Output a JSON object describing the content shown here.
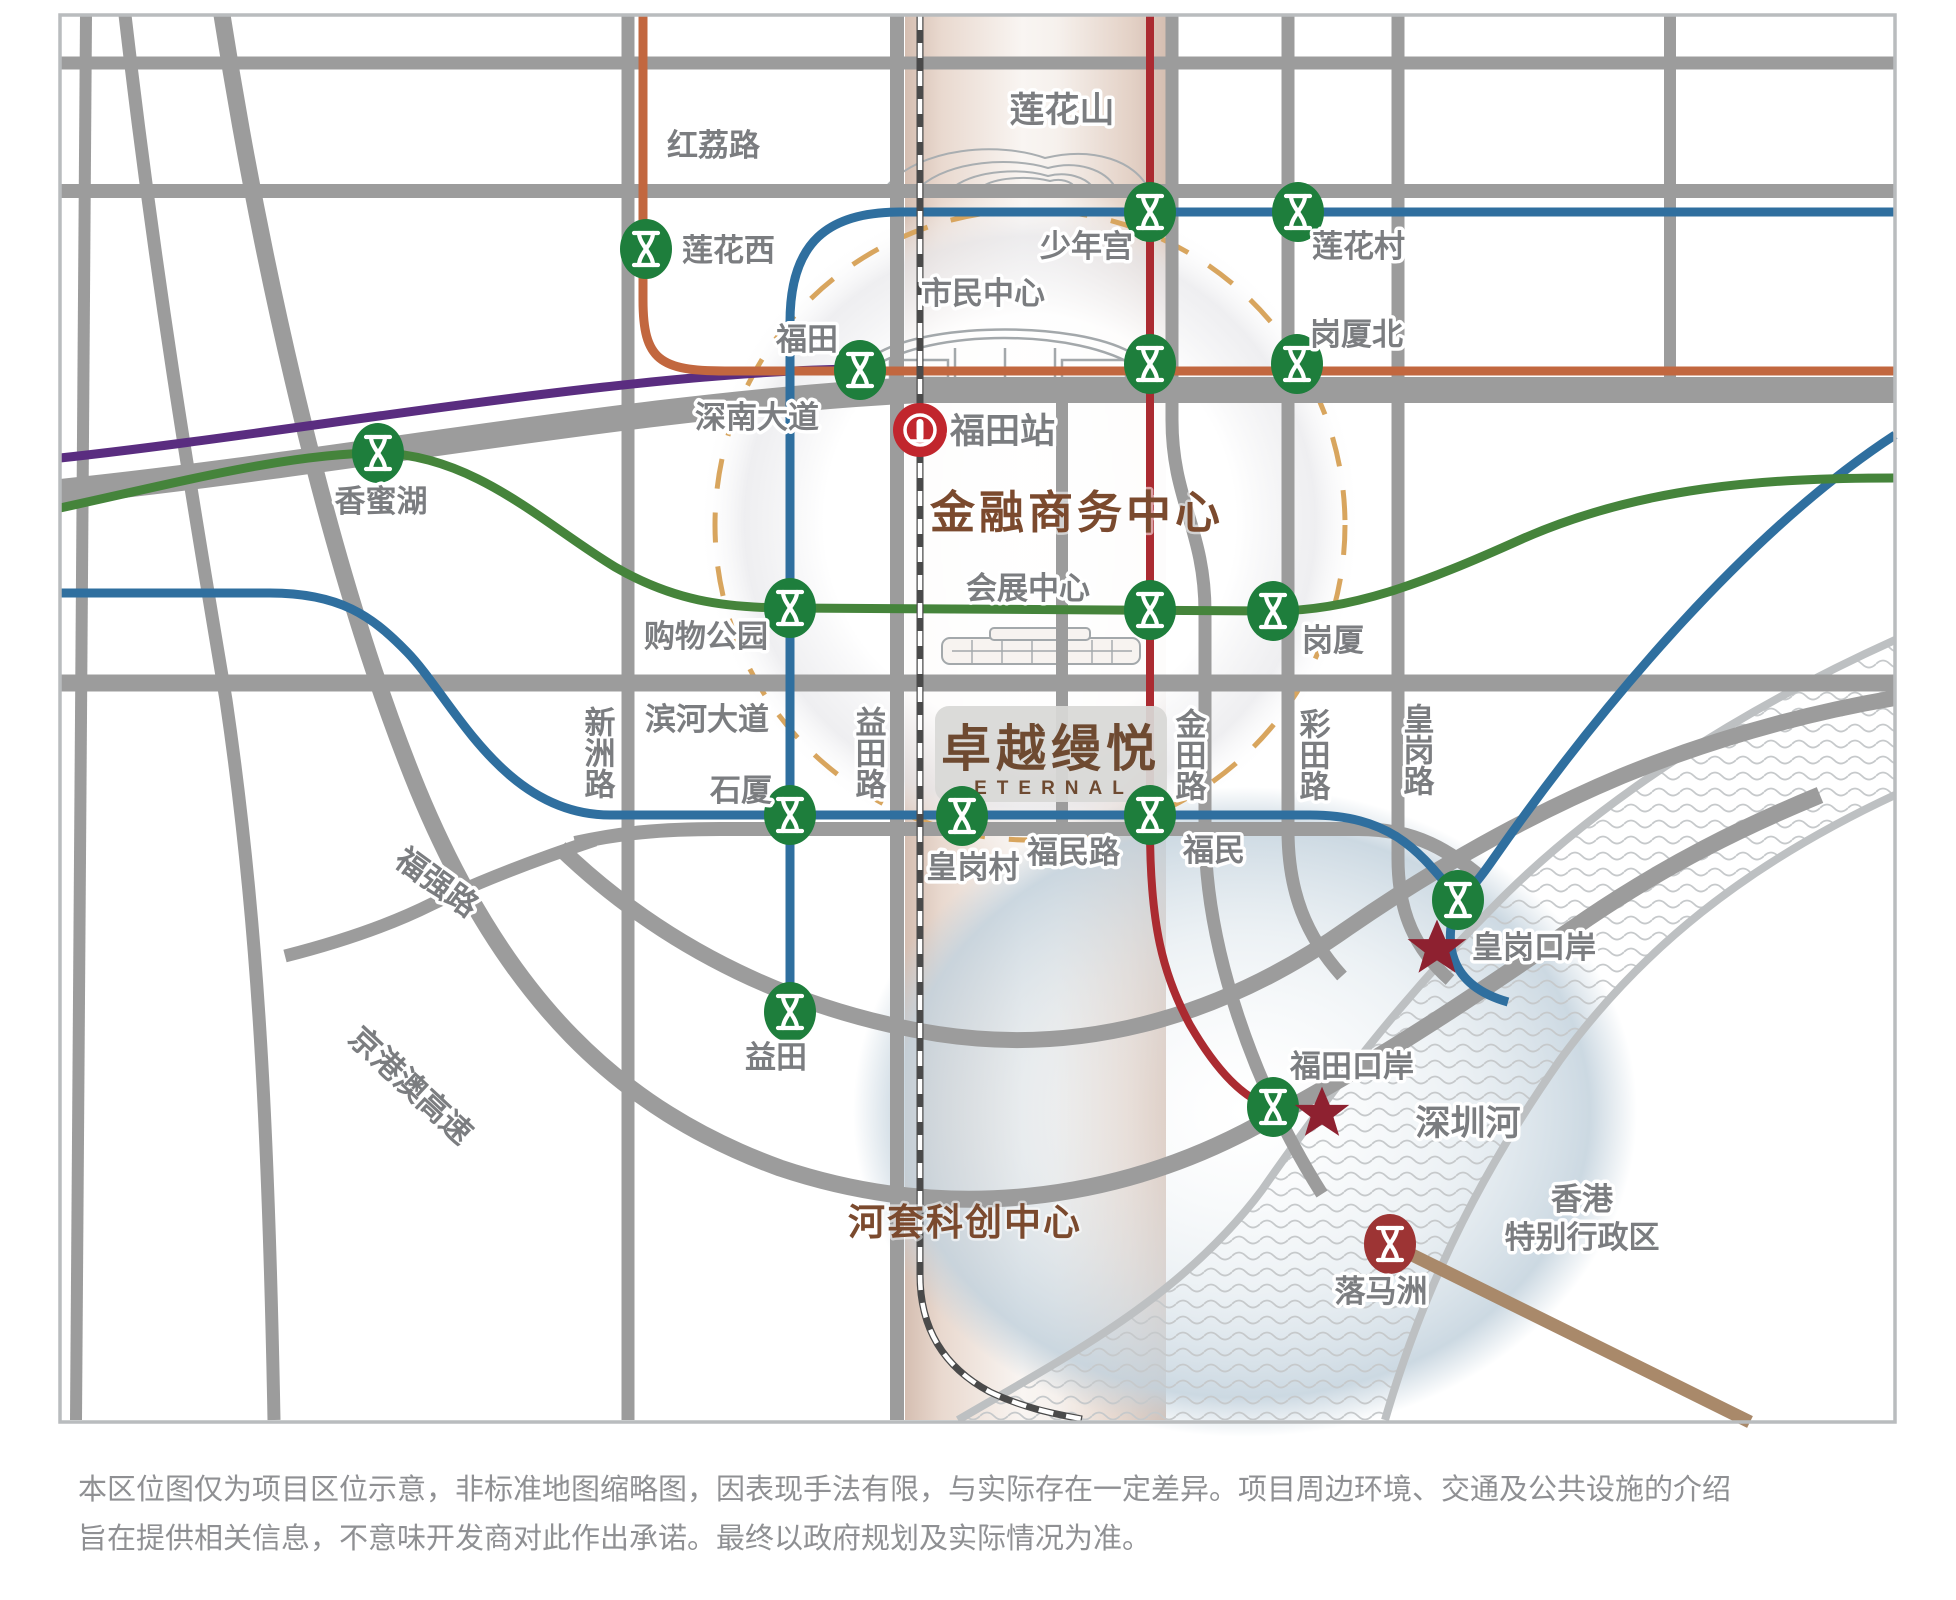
{
  "project": {
    "name_cn": "卓越缦悦",
    "name_en": "ETERNAL"
  },
  "landmarks": {
    "mountain": "莲花山",
    "civic_center": "市民中心",
    "financial_center": "金融商务中心",
    "hetao": "河套科创中心",
    "shenzhen_river": "深圳河",
    "hongkong_line1": "香港",
    "hongkong_line2": "特别行政区"
  },
  "roads": {
    "hongli": "红荔路",
    "shennan": "深南大道",
    "binhe": "滨河大道",
    "xinzhou": "新洲路",
    "yitian": "益田路",
    "jintian": "金田路",
    "caitian": "彩田路",
    "huanggang": "皇岗路",
    "fumin": "福民路",
    "fuqiang": "福强路",
    "jinggangao": "京港澳高速"
  },
  "stations": {
    "lianhuaxi": "莲花西",
    "futian": "福田",
    "shaoniangong": "少年宫",
    "lianhuacun": "莲花村",
    "gangxiabei": "岗厦北",
    "xiangmihu": "香蜜湖",
    "gouwu_park": "购物公园",
    "convention": "会展中心",
    "gangxia": "岗厦",
    "shixia": "石厦",
    "huanggang_village": "皇岗村",
    "fumin": "福民",
    "yitian": "益田",
    "huanggang_port": "皇岗口岸",
    "futian_port": "福田口岸",
    "lok_ma_chau": "落马洲",
    "futian_rail": "福田站"
  },
  "disclaimer": {
    "line1": "本区位图仅为项目区位示意，非标准地图缩略图，因表现手法有限，与实际存在一定差异。项目周边环境、交通及公共设施的介绍",
    "line2": "旨在提供相关信息，不意味开发商对此作出承诺。最终以政府规划及实际情况为准。"
  },
  "colors": {
    "road_gray": "#9c9c9c",
    "line_orange": "#c2673f",
    "line_blue": "#2f6f9f",
    "line_green": "#45843b",
    "line_purple": "#5a2d80",
    "line_red": "#ab2b31",
    "line_brown": "#a9896a",
    "station_green": "#1e7e3c",
    "rail_icon_red": "#c1262d",
    "star_red": "#8e2130",
    "zone_brown": "#7b4a2e",
    "dash_circle_tan": "#d8a55e"
  }
}
